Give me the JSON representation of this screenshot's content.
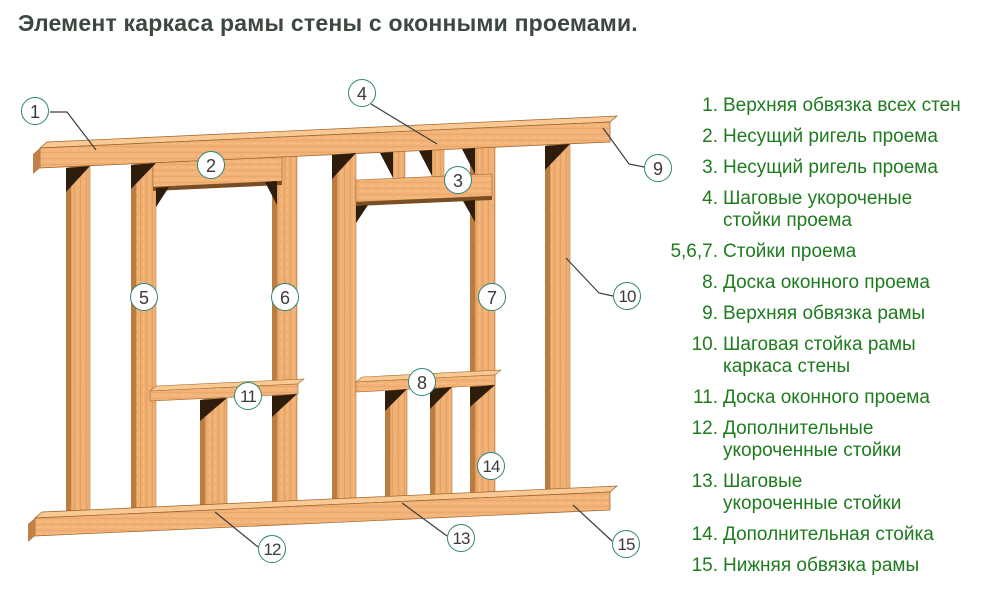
{
  "title": "Элемент каркаса рамы стены с оконными проемами.",
  "legend": [
    {
      "num": "1.",
      "lines": [
        "Верхняя обвязка всех стен"
      ]
    },
    {
      "num": "2.",
      "lines": [
        "Несущий ригель проема"
      ]
    },
    {
      "num": "3.",
      "lines": [
        "Несущий ригель проема"
      ]
    },
    {
      "num": "4.",
      "lines": [
        "Шаговые укороченые",
        "стойки проема"
      ]
    },
    {
      "num": "5,6,7.",
      "lines": [
        "Стойки проема"
      ]
    },
    {
      "num": "8.",
      "lines": [
        "Доска оконного проема"
      ]
    },
    {
      "num": "9.",
      "lines": [
        "Верхняя обвязка рамы"
      ]
    },
    {
      "num": "10.",
      "lines": [
        "Шаговая стойка рамы",
        "каркаса стены"
      ]
    },
    {
      "num": "11.",
      "lines": [
        "Доска оконного проема"
      ]
    },
    {
      "num": "12.",
      "lines": [
        "Дополнительные",
        "укороченные стойки"
      ]
    },
    {
      "num": "13.",
      "lines": [
        "Шаговые",
        "укороченные стойки"
      ]
    },
    {
      "num": "14.",
      "lines": [
        "Дополнительная стойка"
      ]
    },
    {
      "num": "15.",
      "lines": [
        "Нижняя обвязка рамы"
      ]
    }
  ],
  "callouts": [
    {
      "n": "1",
      "x": 35,
      "y": 111
    },
    {
      "n": "2",
      "x": 211,
      "y": 165
    },
    {
      "n": "3",
      "x": 458,
      "y": 180
    },
    {
      "n": "4",
      "x": 362,
      "y": 93
    },
    {
      "n": "5",
      "x": 144,
      "y": 297
    },
    {
      "n": "6",
      "x": 285,
      "y": 297
    },
    {
      "n": "7",
      "x": 492,
      "y": 297
    },
    {
      "n": "8",
      "x": 422,
      "y": 382
    },
    {
      "n": "9",
      "x": 658,
      "y": 168
    },
    {
      "n": "10",
      "x": 627,
      "y": 296
    },
    {
      "n": "11",
      "x": 248,
      "y": 396
    },
    {
      "n": "12",
      "x": 272,
      "y": 549
    },
    {
      "n": "13",
      "x": 461,
      "y": 538
    },
    {
      "n": "14",
      "x": 491,
      "y": 466
    },
    {
      "n": "15",
      "x": 626,
      "y": 544
    }
  ],
  "colors": {
    "legend_text": "#1e7b1e",
    "title_text": "#3d4840",
    "callout_border": "#2e8578",
    "callout_number": "#3a3a3a",
    "leader_line": "#3d3d3d",
    "wood_face": "#f2b278",
    "wood_top_face": "#f9c994",
    "wood_side": "#bb7c40",
    "wood_end_cap": "#c08048",
    "shadow_wedge": "#2f1d0c",
    "header_underside": "#7a4e24"
  }
}
